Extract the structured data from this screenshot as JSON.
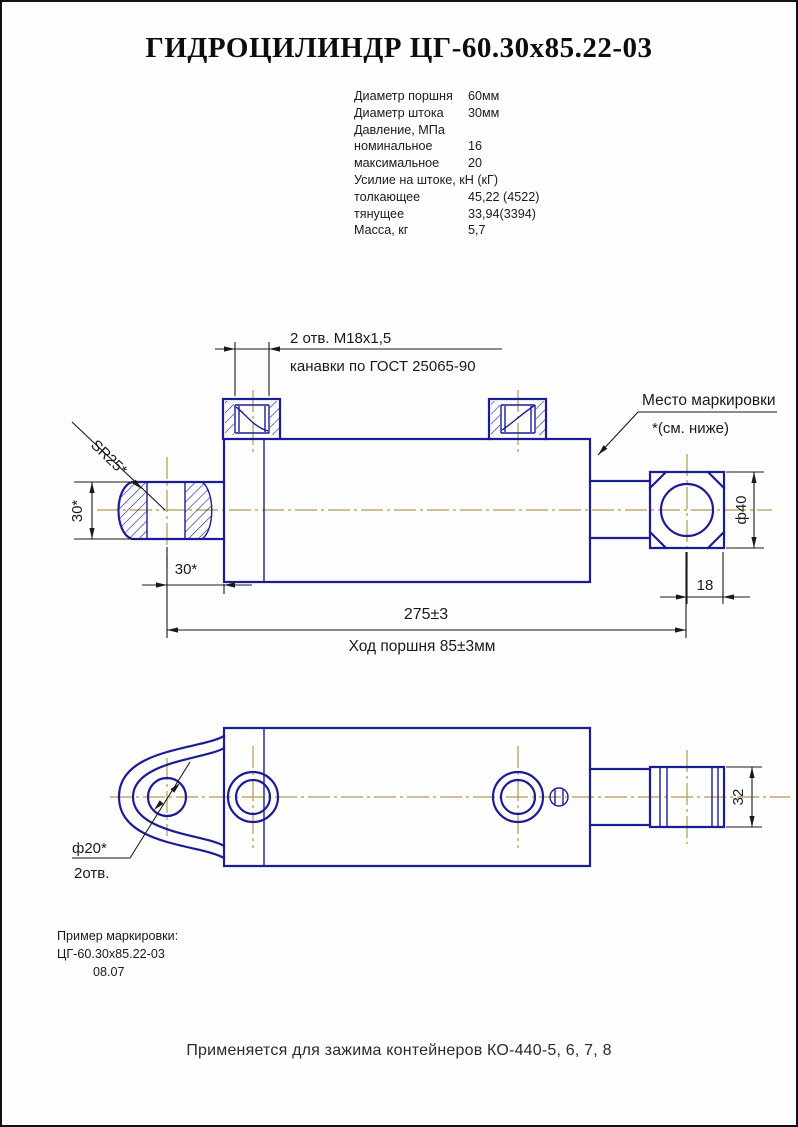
{
  "page": {
    "title": "ГИДРОЦИЛИНДР ЦГ-60.30х85.22-03",
    "footer": "Применяется для зажима контейнеров КО-440-5, 6, 7, 8"
  },
  "specs": {
    "rows": [
      {
        "label": "Диаметр поршня",
        "value": "60мм"
      },
      {
        "label": "Диаметр штока",
        "value": "30мм"
      },
      {
        "label": "Давление, МПа",
        "value": ""
      },
      {
        "label": "номинальное",
        "value": "16"
      },
      {
        "label": "максимальное",
        "value": "20"
      },
      {
        "label": "Усилие на штоке, кН (кГ)",
        "value": ""
      },
      {
        "label": "толкающее",
        "value": "45,22 (4522)"
      },
      {
        "label": "тянущее",
        "value": "33,94(3394)"
      },
      {
        "label": "Масса, кг",
        "value": "5,7"
      }
    ]
  },
  "drawing": {
    "top_note": {
      "line1": "2 отв. М18х1,5",
      "line2": "канавки по ГОСТ 25065-90"
    },
    "marking_note": {
      "line1": "Место маркировки",
      "line2": "*(см. ниже)"
    },
    "dims": {
      "sphere_radius": "SR25*",
      "eye_height": "30*",
      "eye_to_body": "30*",
      "overall_length": "275±3",
      "piston_stroke": "Ход поршня 85±3мм",
      "rod_end_dia": "ф40",
      "rod_end_length": "18",
      "rod_end_width": "32",
      "eye_hole_dia": "ф20*",
      "eye_hole_qty": "2отв."
    },
    "marking_example": {
      "caption": "Пример маркировки:",
      "line1": "ЦГ-60.30х85.22-03",
      "line2": "08.07"
    },
    "colors": {
      "outline": "#1c1c96",
      "centerline": "#b3984f",
      "dimension": "#1a1a1a"
    }
  }
}
